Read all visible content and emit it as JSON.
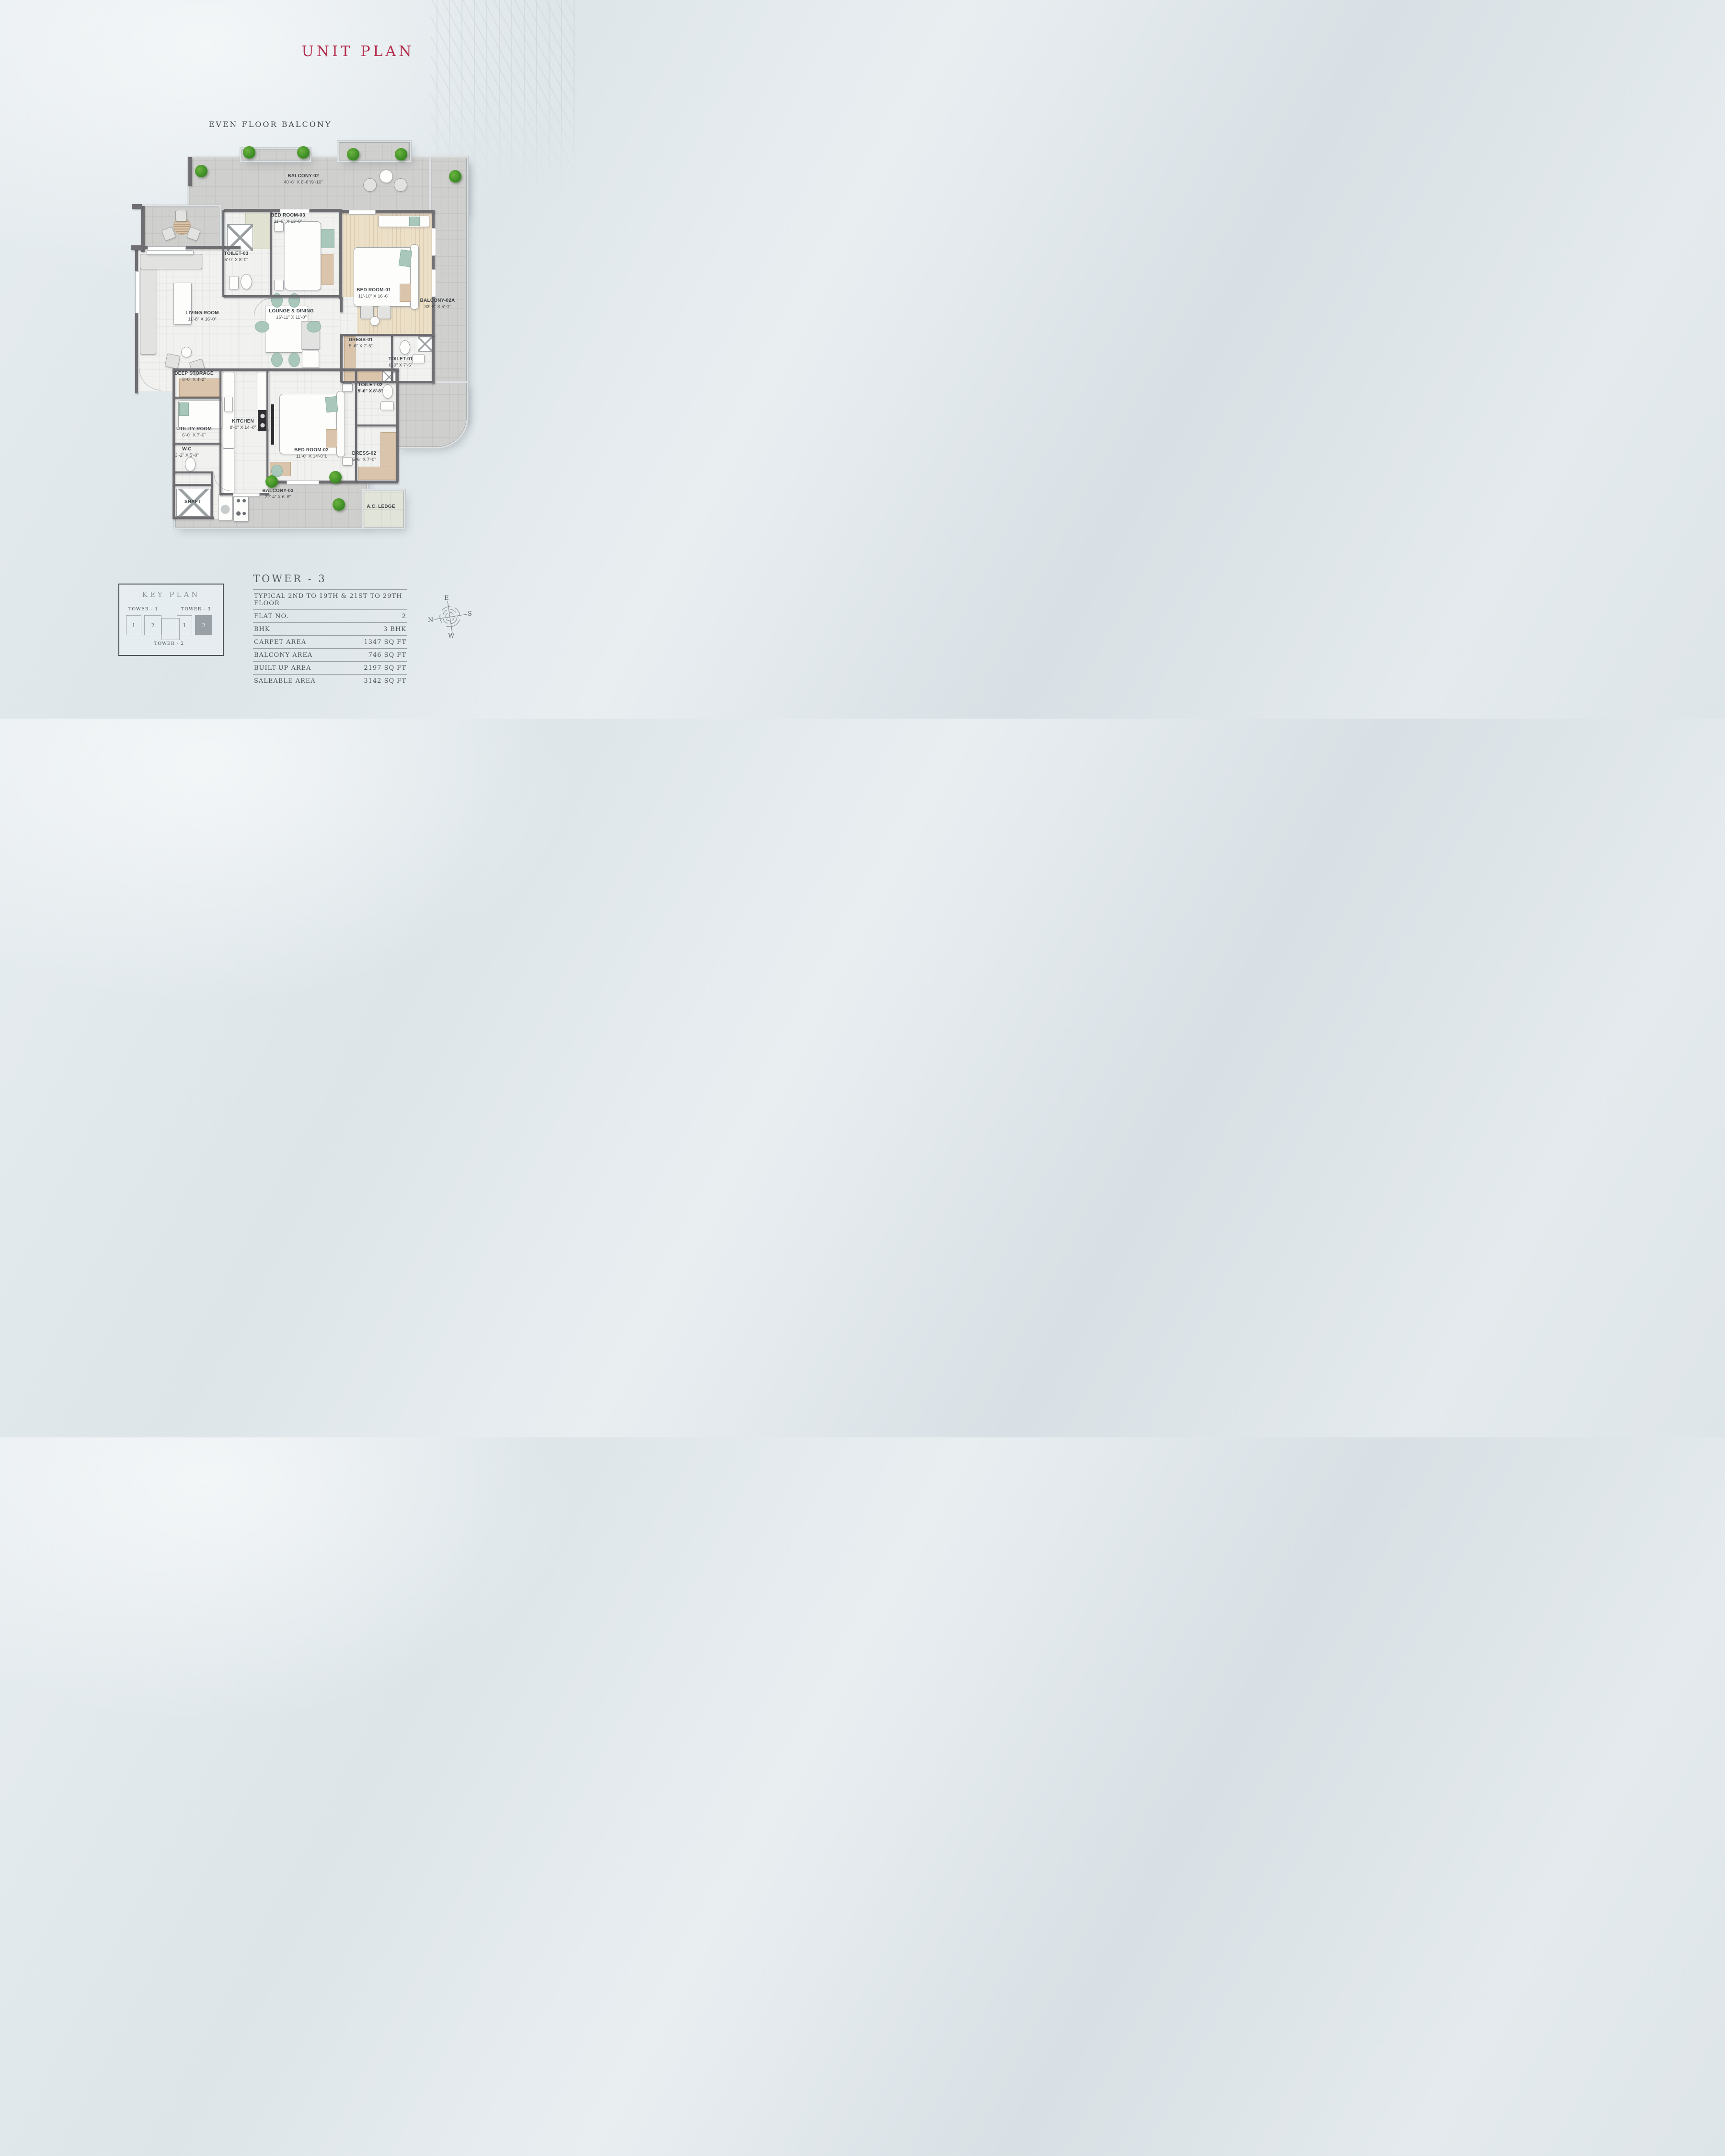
{
  "page": {
    "title": "UNIT PLAN",
    "balcony_heading": "EVEN FLOOR BALCONY"
  },
  "colors": {
    "accent_red": "#b32c4d",
    "wall_gray": "#6e6e73",
    "balcony_tile": "#cfcfcd",
    "interior_tile": "#f1f1ef",
    "wood_floor": "#ecdfc7",
    "teal_accent": "#a9c7ba",
    "tan_accent": "#dac4ab",
    "plant_green": "#3f8f27",
    "page_background": "#e2e9ec"
  },
  "plan": {
    "rooms": [
      {
        "name": "BALCONY-02",
        "dims": "40'-6\" X 6'-6\"/9'-10\""
      },
      {
        "name": "BED ROOM-03",
        "dims": "11'-0\" X 13'-0\""
      },
      {
        "name": "TOILET-03",
        "dims": "5'-0\" X 8'-0\""
      },
      {
        "name": "BED ROOM-01",
        "dims": "11'-10\" X 16'-6\""
      },
      {
        "name": "BALCONY-02A",
        "dims": "33'-6\" X 5'-0\""
      },
      {
        "name": "LIVING ROOM",
        "dims": "11'-8\" X 16'-0\""
      },
      {
        "name": "LOUNGE & DINING",
        "dims": "16'-11\" X 11'-0\""
      },
      {
        "name": "DRESS-01",
        "dims": "5'-6\" X 7'-5\""
      },
      {
        "name": "TOILET-01",
        "dims": "6'-0\" X 7'-5\""
      },
      {
        "name": "TOILET-02",
        "dims": "5'-6\" X 8'-8\""
      },
      {
        "name": "DEEP STORAGE",
        "dims": "6'-0\" X 4'-2\""
      },
      {
        "name": "UTILITY ROOM",
        "dims": "6'-0\" X 7'-0\""
      },
      {
        "name": "KITCHEN",
        "dims": "8'-0\" X 14'-0\""
      },
      {
        "name": "W.C",
        "dims": "3'-2\" X 5'-0\""
      },
      {
        "name": "SHAFT",
        "dims": ""
      },
      {
        "name": "BED ROOM-02",
        "dims": "11'-0\" X 14'-0\"1"
      },
      {
        "name": "DRESS-02",
        "dims": "5'-6\" X 7'-0\""
      },
      {
        "name": "BALCONY-03",
        "dims": "22'-4\" X 6'-6\""
      },
      {
        "name": "A.C. LEDGE",
        "dims": ""
      }
    ]
  },
  "key_plan": {
    "title": "KEY PLAN",
    "towers": [
      {
        "label": "TOWER - 1",
        "units": [
          "1",
          "2"
        ]
      },
      {
        "label": "TOWER - 2",
        "units": []
      },
      {
        "label": "TOWER - 3",
        "units": [
          "1",
          "2"
        ],
        "highlighted_unit": "2"
      }
    ]
  },
  "info_table": {
    "title": "TOWER - 3",
    "rows": [
      {
        "label": "TYPICAL 2ND TO 19TH & 21ST TO 29TH FLOOR",
        "value": ""
      },
      {
        "label": "FLAT NO.",
        "value": "2"
      },
      {
        "label": "BHK",
        "value": "3 BHK"
      },
      {
        "label": "CARPET AREA",
        "value": "1347 SQ FT"
      },
      {
        "label": "BALCONY AREA",
        "value": "746 SQ FT"
      },
      {
        "label": "BUILT-UP AREA",
        "value": "2197 SQ FT"
      },
      {
        "label": "SALEABLE AREA",
        "value": "3142 SQ FT"
      }
    ]
  },
  "compass": {
    "n": "N",
    "e": "E",
    "s": "S",
    "w": "W"
  }
}
